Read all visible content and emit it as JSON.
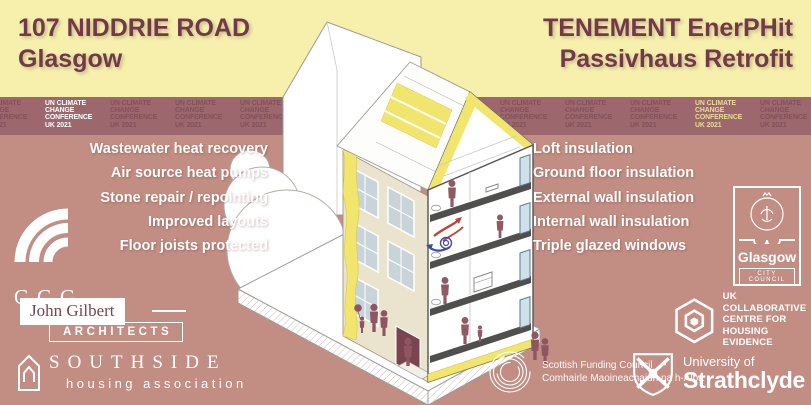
{
  "header": {
    "left": {
      "line1": "107 NIDDRIE ROAD",
      "line2": "Glasgow"
    },
    "right": {
      "line1": "TENEMENT EnerPHit",
      "line2": "Passivhaus Retrofit"
    }
  },
  "cop26_banner": {
    "lines": [
      "UN CLIMATE",
      "CHANGE",
      "CONFERENCE",
      "UK 2021"
    ],
    "repeat_count": 14,
    "highlight_white_index": 1,
    "highlight_yellow_index": 11
  },
  "left_features": {
    "items": [
      "Wastewater heat recovery",
      "Air source heat pumps",
      "Stone repair / repointing",
      "Improved layouts",
      "Floor joists protected"
    ]
  },
  "right_features": {
    "items": [
      "Loft insulation",
      "Ground floor insulation",
      "External wall insulation",
      "Internal wall insulation",
      "Triple glazed windows"
    ]
  },
  "logos": {
    "ccg": {
      "label": "CCG",
      "icon": "ccg-arcs-icon"
    },
    "john_gilbert": {
      "name": "John Gilbert",
      "suffix": "ARCHITECTS"
    },
    "southside": {
      "name": "SOUTHSIDE",
      "subtitle": "housing association",
      "icon": "house-outline-icon"
    },
    "glasgow_city_council": {
      "name": "Glasgow",
      "subtitle": "CITY COUNCIL",
      "icon": "glasgow-crest-icon"
    },
    "ukcche": {
      "line1": "UK COLLABORATIVE",
      "line2": "CENTRE FOR",
      "line3": "HOUSING EVIDENCE",
      "icon": "hexagon-icon"
    },
    "scottish_funding_council": {
      "line1": "Scottish Funding Council",
      "line2": "Comhairle Maoineachaidh na h-Alba",
      "icon": "spiral-circles-icon"
    },
    "strathclyde": {
      "line1": "University of",
      "line2": "Strathclyde",
      "icon": "shield-saltire-icon"
    }
  },
  "colors": {
    "background_rose": "#C28D83",
    "band_yellow": "#F6F0AC",
    "banner_mauve": "#9C676D",
    "banner_text_dim": "#84525C",
    "banner_text_white": "#FFFFFF",
    "banner_text_yellow": "#E9DC96",
    "title_maroon": "#713A49",
    "text_white": "#FFFFFF",
    "facade_sandstone": "#EAE3CD",
    "insulation_yellow": "#F1E56E",
    "figure_maroon": "#8E5660",
    "arrow_red": "#C04438",
    "arrow_blue": "#3A4FA0"
  }
}
